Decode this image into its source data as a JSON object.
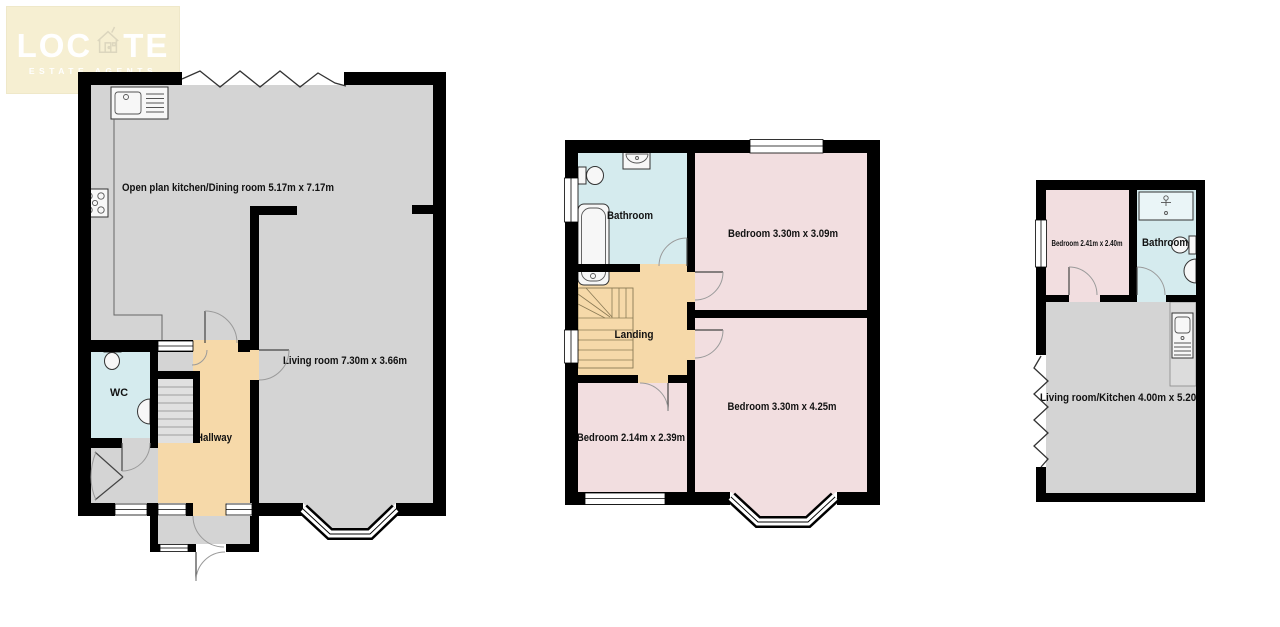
{
  "logo": {
    "brand_pre": "LOC",
    "brand_post": "TE",
    "tagline": "ESTATE AGENTS"
  },
  "colors": {
    "wall": "#000000",
    "floor_grey": "#D4D4D4",
    "floor_pink": "#F2DEE0",
    "floor_blue": "#D5EBEE",
    "floor_tan": "#F6D9A9",
    "logo_bg": "#F6EFD2",
    "logo_text": "#FFFFFF"
  },
  "floors": {
    "ground": {
      "kitchen_dining": "Open plan kitchen/Dining room 5.17m x 7.17m",
      "living": "Living room 7.30m x 3.66m",
      "wc": "WC",
      "hallway": "Hallway"
    },
    "first": {
      "bathroom": "Bathroom",
      "bedroom_front": "Bedroom 3.30m x 3.09m",
      "landing": "Landing",
      "bedroom_small": "Bedroom 2.14m x 2.39m",
      "bedroom_back": "Bedroom 3.30m x 4.25m"
    },
    "annex": {
      "bedroom": "Bedroom 2.41m x 2.40m",
      "bathroom": "Bathroom",
      "living_kitchen": "Living room/Kitchen 4.00m x 5.20m"
    }
  }
}
